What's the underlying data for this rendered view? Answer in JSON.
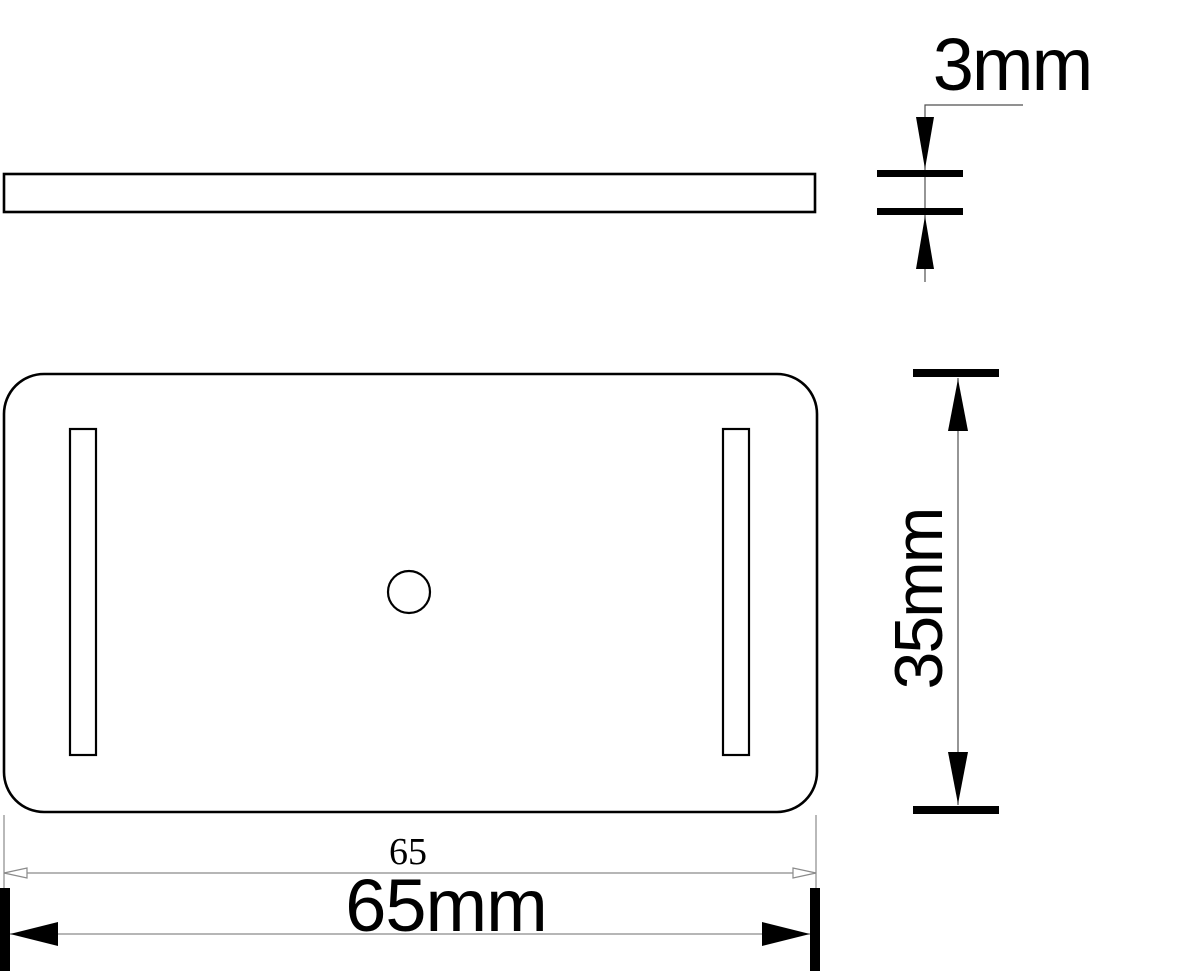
{
  "drawing": {
    "type": "technical-dimension-drawing",
    "part": "rectangular plate with two slots and center hole",
    "colors": {
      "paper": "#ffffff",
      "ink": "#000000",
      "dim": "#4f4f4f",
      "thin": "#8a8a8a"
    },
    "dimensions": {
      "thickness": {
        "label": "3mm"
      },
      "height": {
        "label": "35mm"
      },
      "width_reference": {
        "label": "65"
      },
      "width": {
        "label": "65mm"
      }
    }
  }
}
